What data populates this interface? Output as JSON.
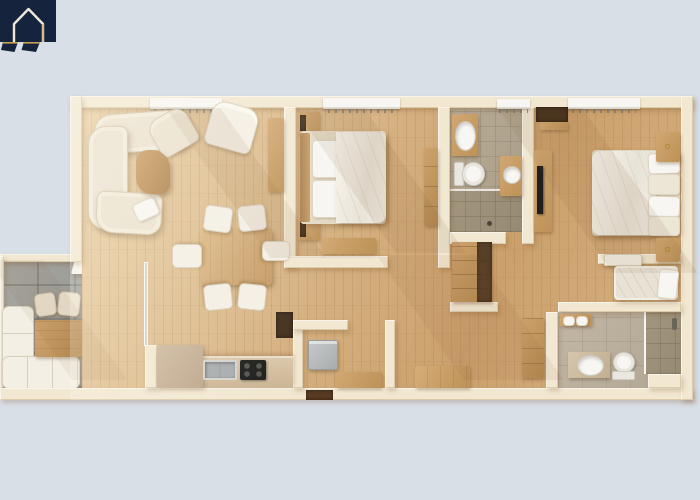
{
  "scene": {
    "kind": "3d-floor-plan-top-down-render",
    "units": "none",
    "visible_text": "none"
  },
  "brand": {
    "logo": "house-outline-badge"
  },
  "colors": {
    "background": "#d9dfe7",
    "wall": "#f2e8d2",
    "woodA": "#e8cda0",
    "woodB": "#d7b384",
    "woodC": "#cba06c",
    "plankLine": "rgba(120,78,38,0.12)",
    "tileBath": "#b7ab96",
    "tileShower": "#a2967f",
    "tileBath2": "#c2b7a5",
    "stone": "#9c9c97",
    "stoneLine": "rgba(55,55,50,0.22)",
    "furnWoodA": "#d2a873",
    "furnWoodB": "#bd9257",
    "darkWood": "#46321f",
    "whiteFabric": "#f3efe4",
    "creamFabric": "#eae1cf",
    "appliance": "#b6b9ba",
    "blackAppliance": "#1f1f1d",
    "porcelain": "#f7f6f2",
    "navy": "#16233c",
    "gold": "#c9a050",
    "logoLine": "#eee8d8",
    "shadow": "rgba(120,80,40,0.25)"
  },
  "rooms": {
    "terrace": {
      "name": "terrace"
    },
    "living": {
      "name": "living-room"
    },
    "dining": {
      "name": "dining-area"
    },
    "kitchen": {
      "name": "kitchen"
    },
    "bedroom2": {
      "name": "bedroom"
    },
    "bathroom1": {
      "name": "bathroom"
    },
    "hall": {
      "name": "hallway"
    },
    "laundry": {
      "name": "laundry-room"
    },
    "master": {
      "name": "master-bedroom"
    },
    "nook": {
      "name": "single-bed-nook"
    },
    "bathroom2": {
      "name": "ensuite-bathroom"
    }
  },
  "furniture": {
    "terrace": [
      "l-shaped-outdoor-sofa",
      "outdoor-table",
      "stool",
      "stool",
      "ottoman"
    ],
    "living": [
      "curved-sectional-sofa",
      "throw-pillow",
      "armchair",
      "armchair",
      "coffee-table",
      "sideboard"
    ],
    "dining": [
      "dining-table",
      "dining-chair",
      "dining-chair",
      "dining-chair",
      "dining-chair",
      "dining-chair",
      "dining-chair"
    ],
    "kitchen": [
      "counter",
      "marble-worktop",
      "kitchen-sink",
      "cooktop",
      "pantry-cabinet"
    ],
    "bedroom2": [
      "double-bed",
      "nightstand",
      "nightstand",
      "foot-bench",
      "wardrobe"
    ],
    "bathroom1": [
      "vanity-sink",
      "second-vanity-sink",
      "toilet",
      "walk-in-shower"
    ],
    "hall": [
      "bench",
      "closet"
    ],
    "laundry": [
      "washing-machine",
      "cabinet"
    ],
    "master": [
      "double-bed",
      "nightstand",
      "nightstand",
      "dresser",
      "tv",
      "open-closet",
      "shelf"
    ],
    "nook": [
      "single-bed"
    ],
    "bathroom2": [
      "vanity-sink",
      "toilet",
      "walk-in-shower",
      "towel-shelf",
      "wardrobe"
    ]
  },
  "openings": {
    "windows": 4,
    "entry_door": 1,
    "glass-terrace-door": 1
  }
}
